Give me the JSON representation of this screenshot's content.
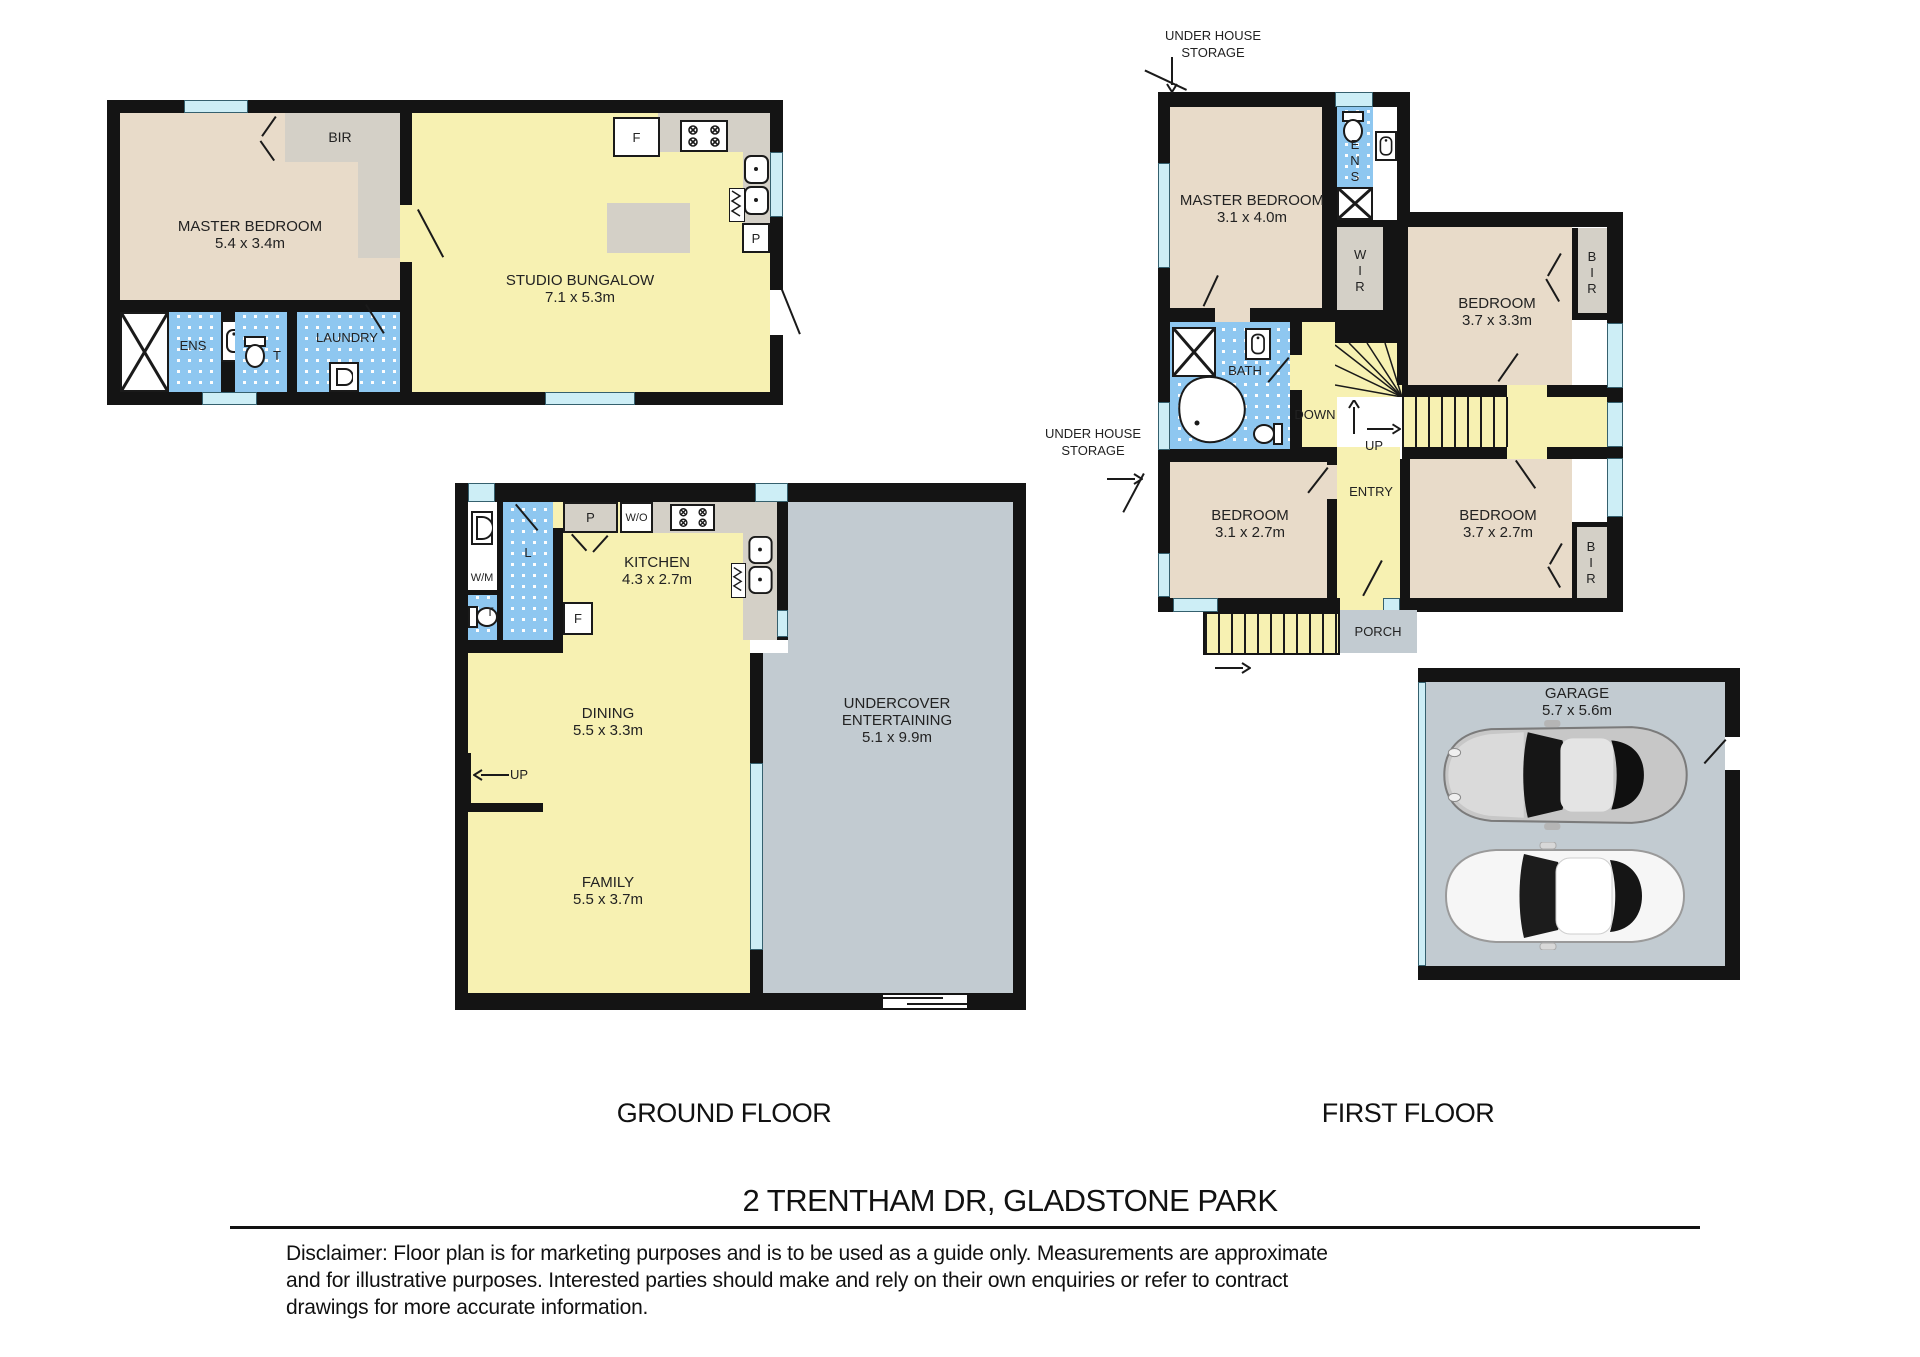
{
  "title": "2 TRENTHAM DR, GLADSTONE PARK",
  "labels": {
    "ground_floor": "GROUND FLOOR",
    "first_floor": "FIRST FLOOR"
  },
  "disclaimer_lines": [
    "Disclaimer: Floor plan is for marketing purposes and is to be used as a guide only. Measurements  are approximate",
    "and for illustrative purposes. Interested parties should make and rely on their own enquiries or refer to contract",
    "drawings for more accurate information."
  ],
  "bungalow": {
    "master": {
      "name": "MASTER BEDROOM",
      "dims": "5.4 x 3.4m"
    },
    "studio": {
      "name": "STUDIO BUNGALOW",
      "dims": "7.1 x 5.3m"
    },
    "bir": "BIR",
    "ens": "ENS",
    "laundry": "LAUNDRY",
    "wc": "T",
    "fridge": "F",
    "pantry": "P"
  },
  "ground": {
    "kitchen": {
      "name": "KITCHEN",
      "dims": "4.3 x 2.7m"
    },
    "dining": {
      "name": "DINING",
      "dims": "5.5 x 3.3m"
    },
    "family": {
      "name": "FAMILY",
      "dims": "5.5 x 3.7m"
    },
    "undercover": {
      "line1": "UNDERCOVER",
      "line2": "ENTERTAINING",
      "dims": "5.1 x 9.9m"
    },
    "pantry": "P",
    "wall_oven": "W/O",
    "fridge": "F",
    "linen": "L",
    "washing_machine": "W/M",
    "wc": "T",
    "up": "UP"
  },
  "first": {
    "master": {
      "name": "MASTER BEDROOM",
      "dims": "3.1 x 4.0m"
    },
    "bedroom1": {
      "name": "BEDROOM",
      "dims": "3.7 x 3.3m"
    },
    "bedroom2": {
      "name": "BEDROOM",
      "dims": "3.1 x 2.7m"
    },
    "bedroom3": {
      "name": "BEDROOM",
      "dims": "3.7 x 2.7m"
    },
    "bath": "BATH",
    "ens": "ENS",
    "wir": "WIR",
    "bir1": "BIR",
    "bir3": "BIR",
    "entry": "ENTRY",
    "porch": "PORCH",
    "down": "DOWN",
    "up": "UP",
    "storage_top": "UNDER HOUSE STORAGE",
    "storage_left": "UNDER HOUSE STORAGE",
    "garage": {
      "name": "GARAGE",
      "dims": "5.7 x 5.6m"
    }
  }
}
